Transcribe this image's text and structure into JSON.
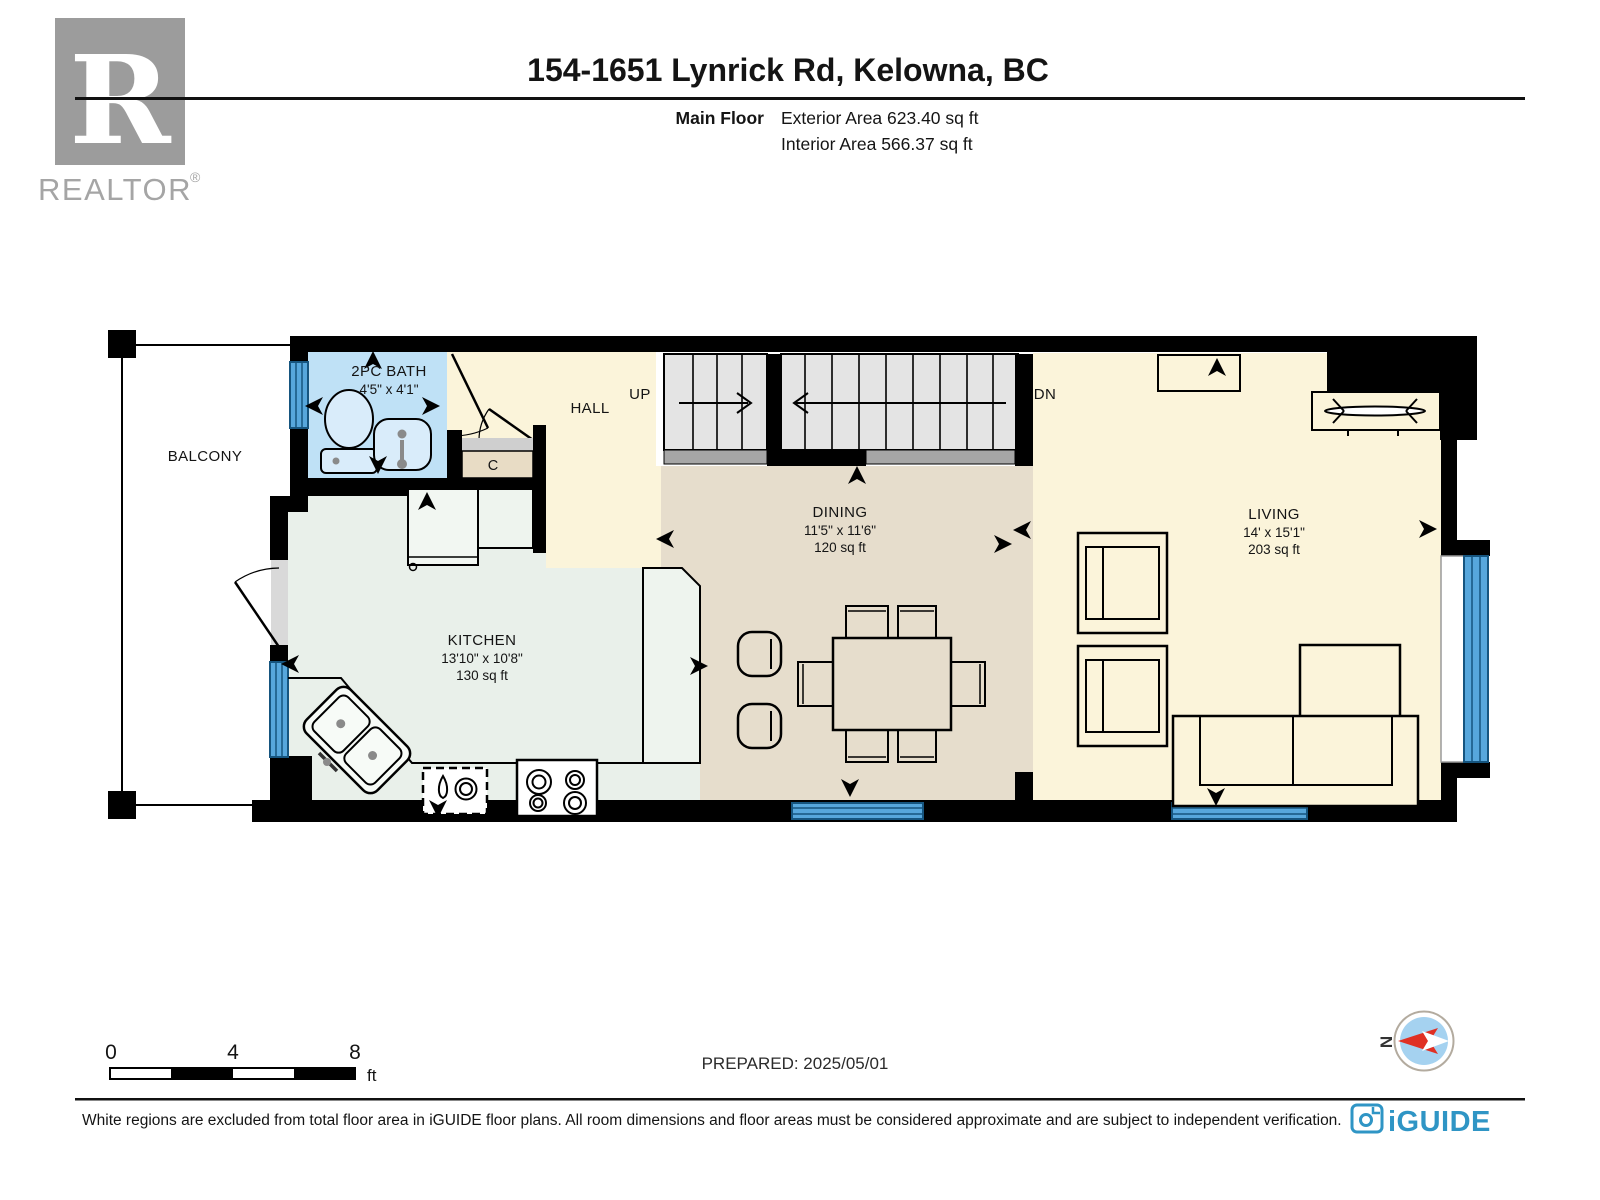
{
  "header": {
    "realtor_logo_letter": "R",
    "realtor_logo_text": "REALTOR",
    "realtor_logo_reg": "®",
    "title": "154-1651 Lynrick Rd, Kelowna, BC",
    "floor_label": "Main Floor",
    "exterior_area": "Exterior Area 623.40 sq ft",
    "interior_area": "Interior Area 566.37 sq ft"
  },
  "plan": {
    "balcony": {
      "name": "BALCONY"
    },
    "bath": {
      "name": "2PC BATH",
      "dims": "4'5\" x 4'1\""
    },
    "hall": {
      "name": "HALL"
    },
    "closet": {
      "name": "C"
    },
    "stairs": {
      "up": "UP",
      "down": "DN"
    },
    "kitchen": {
      "name": "KITCHEN",
      "dims": "13'10\" x 10'8\"",
      "area": "130 sq ft"
    },
    "dining": {
      "name": "DINING",
      "dims": "11'5\" x 11'6\"",
      "area": "120 sq ft"
    },
    "living": {
      "name": "LIVING",
      "dims": "14' x 15'1\"",
      "area": "203 sq ft"
    }
  },
  "scale_bar": {
    "tick0": "0",
    "tick4": "4",
    "tick8": "8",
    "unit": "ft"
  },
  "prepared_label": "PREPARED: 2025/05/01",
  "compass": {
    "north_letter": "N"
  },
  "footer": {
    "disclaimer": "White regions are excluded from total floor area in iGUIDE floor plans. All room dimensions and floor areas must be considered approximate and are subject to independent verification.",
    "brand": "iGUIDE"
  },
  "colors": {
    "wall": "#000000",
    "floor_cream": "#fbf4da",
    "bath_blue": "#bfe1f6",
    "kitchen_mint": "#e9f0ea",
    "dining_tan": "#e6ddcc",
    "stair_gray": "#e4e4e4",
    "landing_gray": "#a6a6a6",
    "window_blue": "#57a7dc",
    "iguide_blue": "#2f95c5",
    "compass_red": "#e03023"
  }
}
